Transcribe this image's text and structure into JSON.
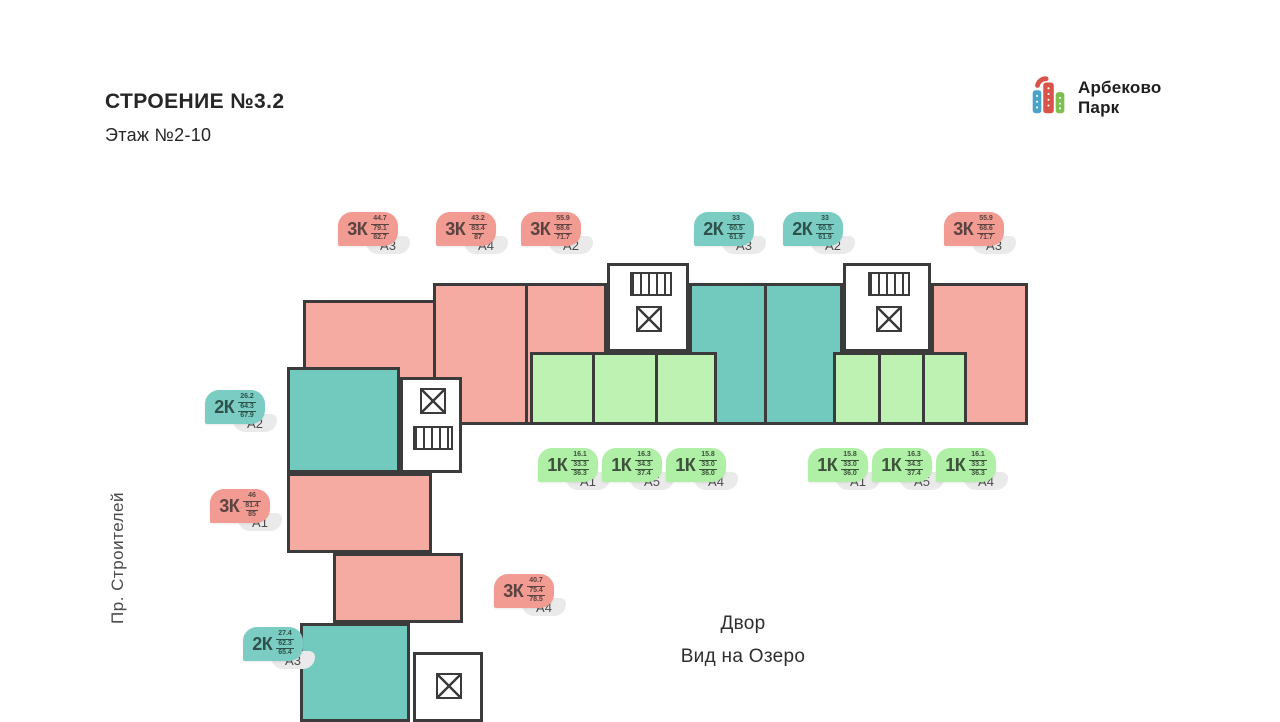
{
  "header": {
    "building_title": "СТРОЕНИЕ №3.2",
    "floor_subtitle": "Этаж №2-10"
  },
  "logo": {
    "name_line1": "Арбеково",
    "name_line2": "Парк"
  },
  "labels": {
    "street_vertical": "Пр. Строителей",
    "yard_line1": "Двор",
    "yard_line2": "Вид на Озеро"
  },
  "colors": {
    "wall": "#3B3B3B",
    "fill3": "#F5ABA1",
    "fill2": "#72C9BE",
    "fill1": "#BDF2B3",
    "rooms3": "#F29B92",
    "rooms2": "#7BCDC3",
    "rooms1": "#AFF0A6",
    "text3": "#5A4340",
    "text2": "#2E514B",
    "text1": "#3C523B",
    "code_bg": "#EAEAEA",
    "logo_red": "#D9534A",
    "logo_teal": "#4AA3C8",
    "logo_green": "#7FBF4F"
  },
  "tags": [
    {
      "type": "3К",
      "areas": [
        "44.7",
        "79.1",
        "82.7"
      ],
      "code": "А3",
      "n": 3,
      "x": 338,
      "y": 212
    },
    {
      "type": "3К",
      "areas": [
        "43.2",
        "83.4",
        "87"
      ],
      "code": "А4",
      "n": 3,
      "x": 436,
      "y": 212
    },
    {
      "type": "3К",
      "areas": [
        "55.9",
        "68.6",
        "71.7"
      ],
      "code": "А2",
      "n": 3,
      "x": 521,
      "y": 212
    },
    {
      "type": "2К",
      "areas": [
        "33",
        "60.5",
        "61.9"
      ],
      "code": "А3",
      "n": 2,
      "x": 694,
      "y": 212
    },
    {
      "type": "2К",
      "areas": [
        "33",
        "60.5",
        "61.9"
      ],
      "code": "А2",
      "n": 2,
      "x": 783,
      "y": 212
    },
    {
      "type": "3К",
      "areas": [
        "55.9",
        "68.6",
        "71.7"
      ],
      "code": "А3",
      "n": 3,
      "x": 944,
      "y": 212
    },
    {
      "type": "2К",
      "areas": [
        "26.2",
        "64.3",
        "67.9"
      ],
      "code": "А2",
      "n": 2,
      "x": 205,
      "y": 390
    },
    {
      "type": "3К",
      "areas": [
        "46",
        "81.4",
        "85"
      ],
      "code": "А1",
      "n": 3,
      "x": 210,
      "y": 489
    },
    {
      "type": "1К",
      "areas": [
        "16.1",
        "33.3",
        "36.3"
      ],
      "code": "А1",
      "n": 1,
      "x": 538,
      "y": 448
    },
    {
      "type": "1К",
      "areas": [
        "16.3",
        "34.3",
        "37.4"
      ],
      "code": "А5",
      "n": 1,
      "x": 602,
      "y": 448
    },
    {
      "type": "1К",
      "areas": [
        "15.8",
        "33.0",
        "36.0"
      ],
      "code": "А4",
      "n": 1,
      "x": 666,
      "y": 448
    },
    {
      "type": "1К",
      "areas": [
        "15.8",
        "33.0",
        "36.0"
      ],
      "code": "А1",
      "n": 1,
      "x": 808,
      "y": 448
    },
    {
      "type": "1К",
      "areas": [
        "16.3",
        "34.3",
        "37.4"
      ],
      "code": "А5",
      "n": 1,
      "x": 872,
      "y": 448
    },
    {
      "type": "1К",
      "areas": [
        "16.1",
        "33.3",
        "36.3"
      ],
      "code": "А4",
      "n": 1,
      "x": 936,
      "y": 448
    },
    {
      "type": "3К",
      "areas": [
        "40.7",
        "75.4",
        "78.5"
      ],
      "code": "А4",
      "n": 3,
      "x": 494,
      "y": 574
    },
    {
      "type": "2К",
      "areas": [
        "27.4",
        "62.3",
        "65.4"
      ],
      "code": "А3",
      "n": 2,
      "x": 243,
      "y": 627
    }
  ]
}
